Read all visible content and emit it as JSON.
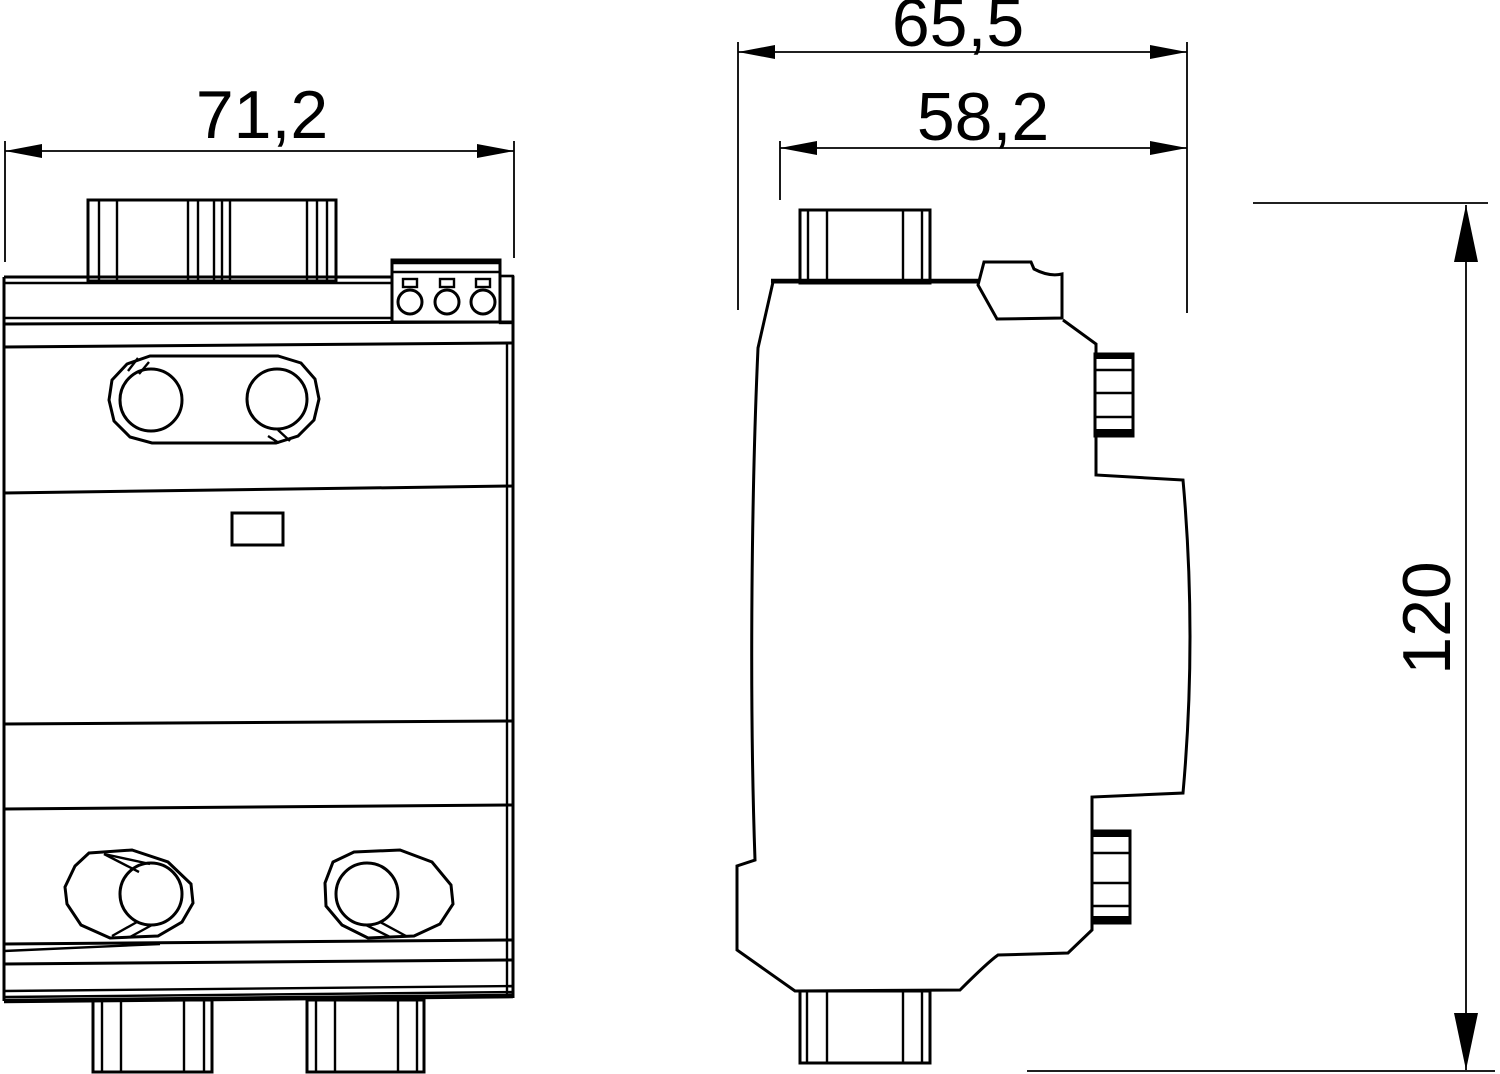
{
  "colors": {
    "background": "#ffffff",
    "line": "#000000"
  },
  "dimensions": {
    "front_width": {
      "label": "71,2"
    },
    "side_overall_depth": {
      "label": "65,5"
    },
    "side_housing_depth": {
      "label": "58,2"
    },
    "overall_height": {
      "label": "120"
    }
  }
}
